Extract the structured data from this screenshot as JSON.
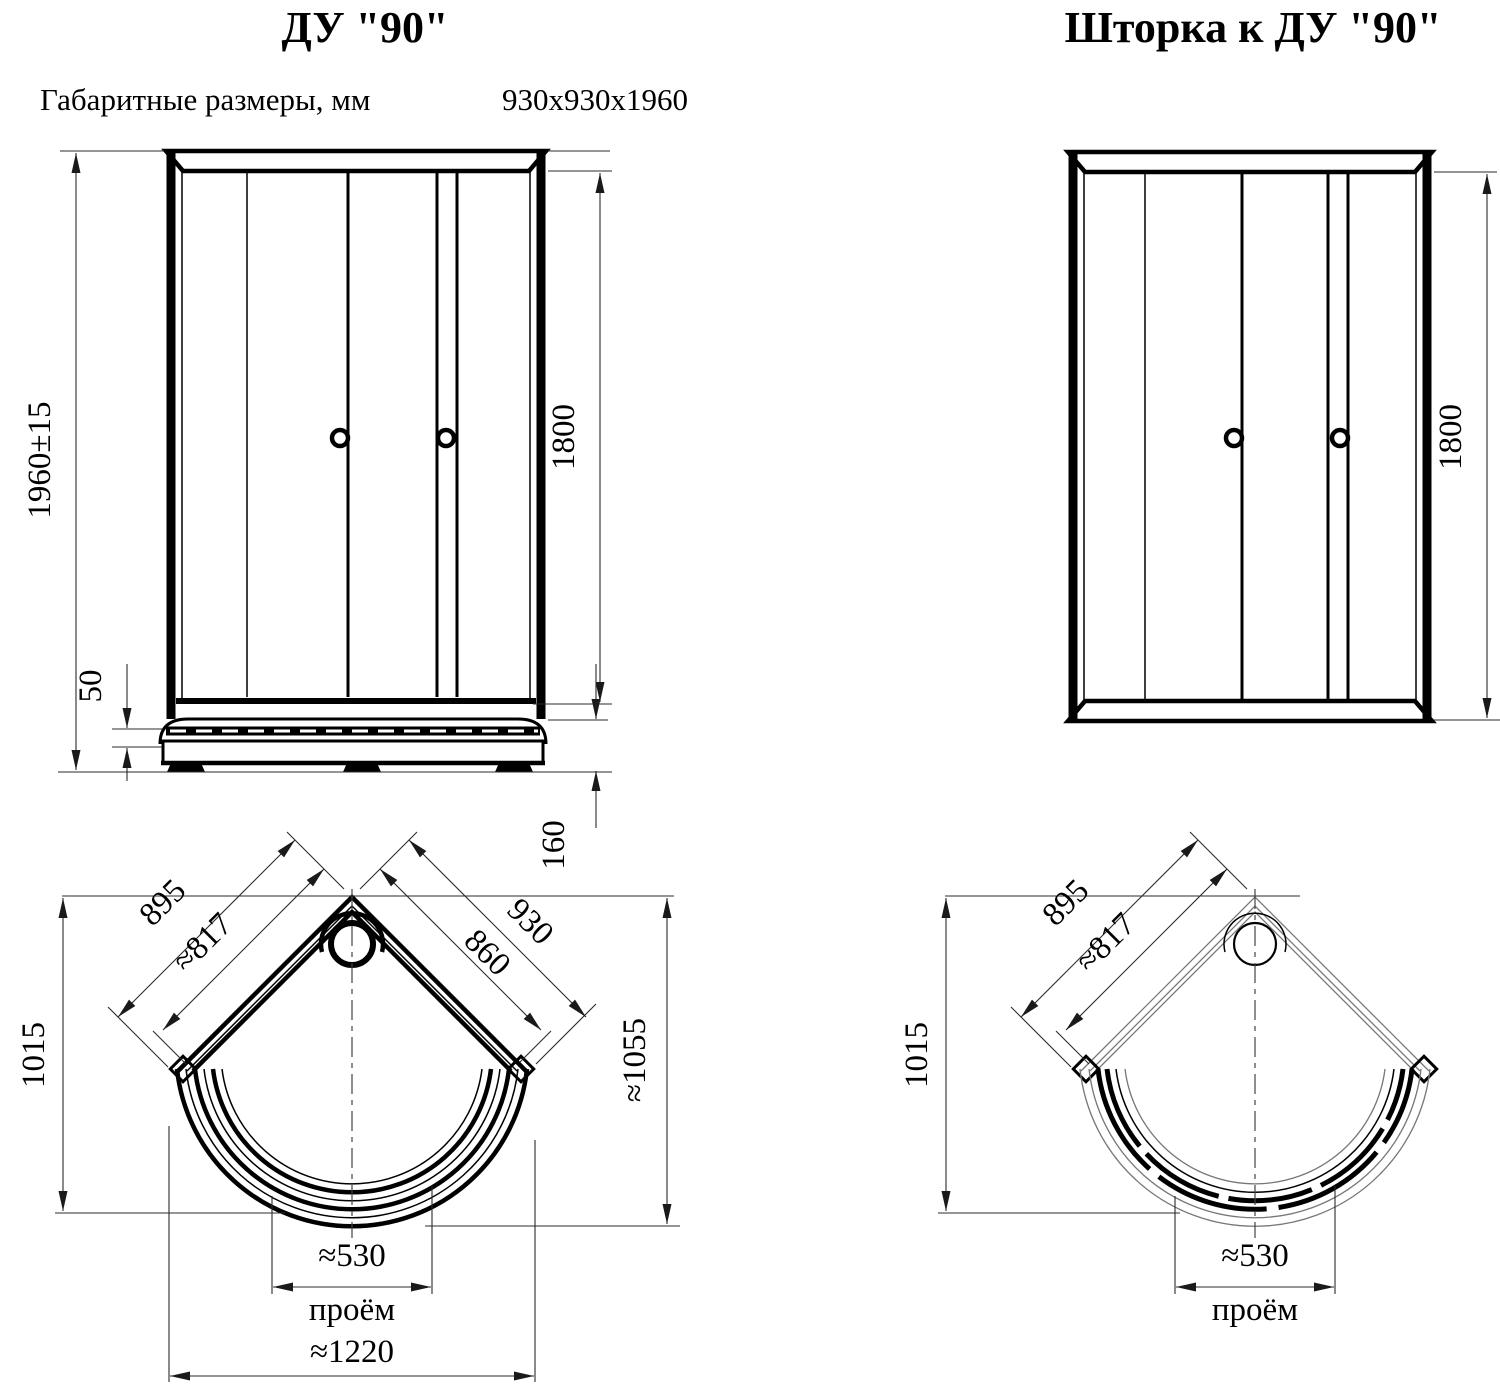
{
  "left": {
    "title": "ДУ \"90\"",
    "dims_label": "Габаритные размеры, мм",
    "dims_value": "930х930х1960",
    "front": {
      "overall_height": "1960±15",
      "door_height": "1800",
      "rim_gap": "50",
      "tray_height": "160"
    },
    "plan": {
      "side_left": "895",
      "side_left_inner": "≈817",
      "side_right": "930",
      "side_right_inner": "860",
      "depth_left": "1015",
      "depth_right": "≈1055",
      "opening_width": "≈530",
      "opening_label": "проём",
      "overall_width": "≈1220"
    }
  },
  "right": {
    "title": "Шторка к ДУ \"90\"",
    "front": {
      "door_height": "1800"
    },
    "plan": {
      "side_left": "895",
      "side_left_inner": "≈817",
      "depth_left": "1015",
      "opening_width": "≈530",
      "opening_label": "проём"
    }
  }
}
